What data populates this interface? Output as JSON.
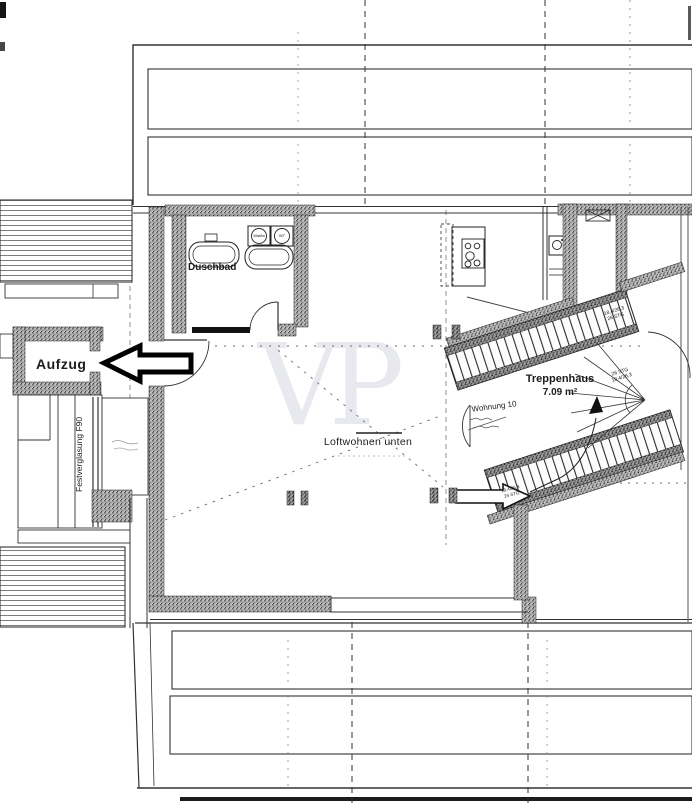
{
  "watermark": {
    "text": "VP",
    "color": "#e7e9ef"
  },
  "rooms": {
    "elevator": "Aufzug",
    "bathroom": "Duschbad",
    "stairwell": "Treppenhaus",
    "stairwell_area": "7.09 m²",
    "apartment": "Wohnung 10",
    "loft": "Loftwohnen unten",
    "glazing": "Festverglasung F90"
  },
  "appliances": {
    "washer": "WaMa",
    "dryer": "WT"
  },
  "stairs": {
    "spec_top_line1": "18,4/26,3",
    "spec_top_line2": "26 STG",
    "spec_mid_line1": "26 STG",
    "spec_mid_line2": "18,4/26,3",
    "spec_entry_line1": "18,4/26,3",
    "spec_entry_line2": "26 STG"
  },
  "colors": {
    "line": "#2a2a2a",
    "wall_speckle": "#bdbdbd",
    "watermark": "#e7e9ef",
    "paper": "#ffffff"
  }
}
